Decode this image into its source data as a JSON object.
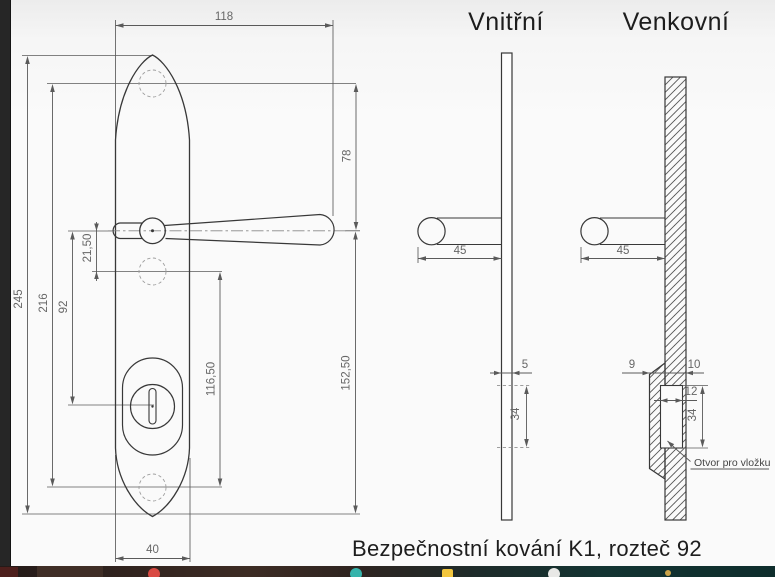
{
  "window": {
    "caption": "Bezpečnostní kování K1, rozteč 92"
  },
  "views": {
    "front": {
      "dim_width_total": "118",
      "dim_top_to_handle": "78",
      "dim_height_total": "245",
      "dim_screw_span": "216",
      "dim_handle_to_cylinder": "92",
      "dim_handle_to_screw": "21,50",
      "dim_screw_to_screw": "116,50",
      "dim_handle_to_bottom": "152,50",
      "dim_plate_width": "40"
    },
    "inner": {
      "title": "Vnitřní",
      "dim_handle_length": "45",
      "dim_plate_thickness": "5",
      "dim_hole_height": "34"
    },
    "outer": {
      "title": "Venkovní",
      "dim_handle_length": "45",
      "dim_boss_depth": "9",
      "dim_plate_thickness": "10",
      "dim_hole_width": "12",
      "dim_hole_height": "34",
      "leader_label": "Otvor pro vložku"
    }
  },
  "colors": {
    "outline": "#383838",
    "dimension": "#5a5a5a",
    "hidden_line": "#9e9e9e",
    "taskbar_red": "#d94a43",
    "taskbar_teal": "#35b3ab",
    "taskbar_yellow": "#f2c63e",
    "taskbar_white": "#e8e8e6"
  },
  "taskbar": {
    "icons": [
      "red-app-icon",
      "teal-app-icon",
      "yellow-app-icon",
      "white-app-icon",
      "gold-dot-icon"
    ]
  }
}
